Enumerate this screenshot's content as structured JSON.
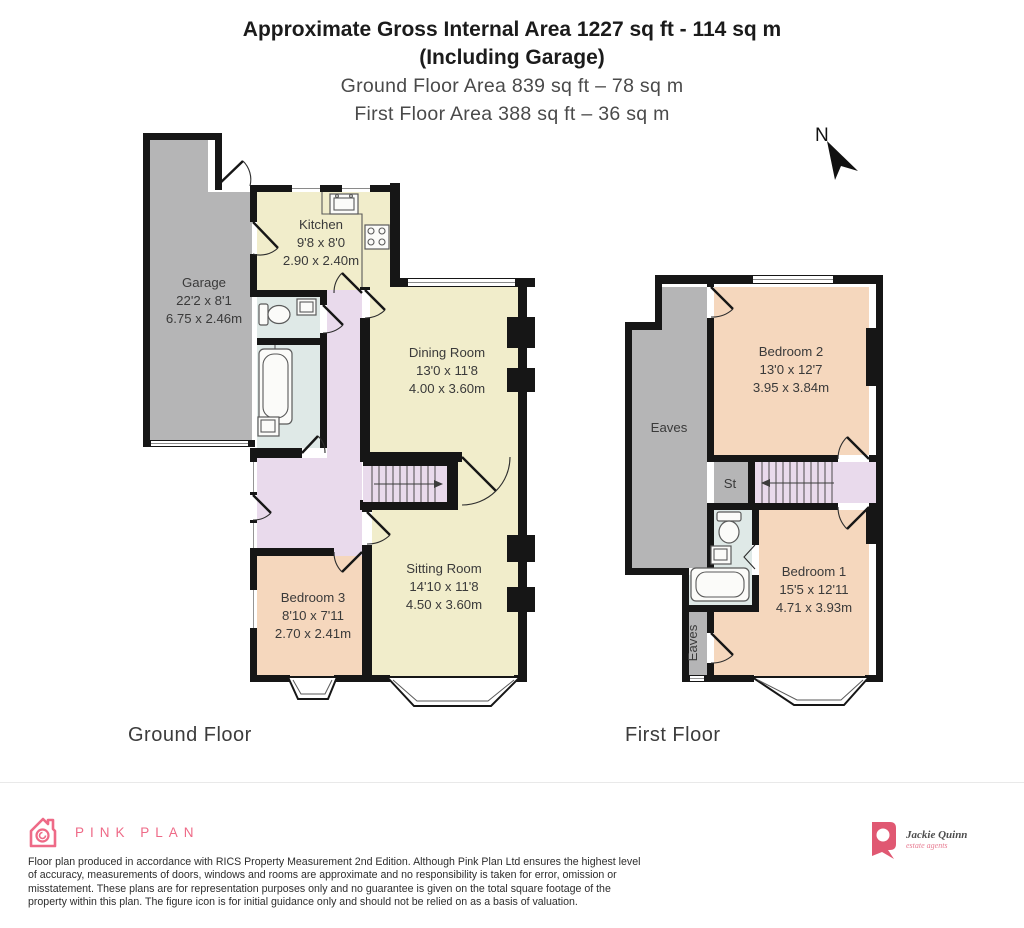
{
  "header": {
    "title_line1": "Approximate Gross Internal Area 1227 sq ft - 114 sq m",
    "title_line2": "(Including Garage)",
    "subtitle_line1": "Ground Floor Area 839 sq ft – 78 sq m",
    "subtitle_line2": "First Floor Area 388 sq ft – 36 sq m"
  },
  "compass": {
    "label": "N"
  },
  "ground_floor": {
    "caption": "Ground Floor",
    "rooms": {
      "garage": {
        "name": "Garage",
        "imperial": "22'2 x 8'1",
        "metric": "6.75 x 2.46m"
      },
      "kitchen": {
        "name": "Kitchen",
        "imperial": "9'8 x 8'0",
        "metric": "2.90 x 2.40m"
      },
      "dining": {
        "name": "Dining Room",
        "imperial": "13'0 x 11'8",
        "metric": "4.00 x 3.60m"
      },
      "sitting": {
        "name": "Sitting Room",
        "imperial": "14'10 x 11'8",
        "metric": "4.50 x 3.60m"
      },
      "bedroom3": {
        "name": "Bedroom 3",
        "imperial": "8'10 x 7'11",
        "metric": "2.70 x 2.41m"
      }
    }
  },
  "first_floor": {
    "caption": "First Floor",
    "rooms": {
      "bedroom2": {
        "name": "Bedroom 2",
        "imperial": "13'0 x 12'7",
        "metric": "3.95 x 3.84m"
      },
      "bedroom1": {
        "name": "Bedroom 1",
        "imperial": "15'5 x 12'11",
        "metric": "4.71 x 3.93m"
      },
      "eaves_large": {
        "name": "Eaves"
      },
      "eaves_small": {
        "name": "Eaves"
      },
      "storage": {
        "name": "St"
      }
    }
  },
  "footer": {
    "pinkplan_brand": "PINK PLAN",
    "disclaimer": "Floor plan produced in accordance with RICS Property Measurement 2nd Edition. Although Pink Plan Ltd ensures the highest level of accuracy, measurements of doors, windows and rooms are approximate and no responsibility is taken for error, omission or misstatement. These plans are for representation purposes only and no guarantee is given on the total square footage of the property within this plan. The figure icon is for initial guidance only and should not be relied on as a basis of valuation.",
    "agent_name": "Jackie Quinn",
    "agent_tagline": "estate agents"
  },
  "colors": {
    "brand_pink": "#ee6a87",
    "wall_black": "#161616",
    "room_cream": "#f1edcb",
    "room_peach": "#f5d7bd",
    "hall_lilac": "#e9daec",
    "bath_blue": "#dfe9e7",
    "garage_gray": "#b5b5b6"
  }
}
